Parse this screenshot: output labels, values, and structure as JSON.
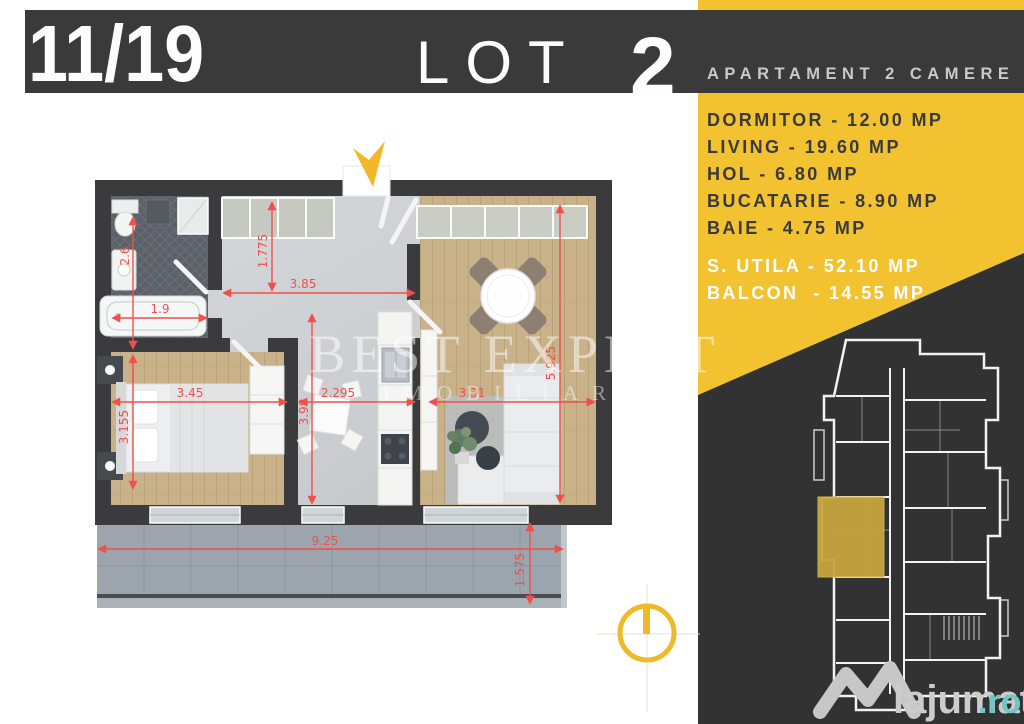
{
  "header": {
    "apartment_fraction": "11/19",
    "lot_label": "LOT",
    "lot_number": "2",
    "subtitle": "APARTAMENT 2 CAMERE"
  },
  "room_list": [
    "DORMITOR - 12.00 MP",
    "LIVING - 19.60 MP",
    "HOL - 6.80 MP",
    "BUCATARIE - 8.90 MP",
    "BAIE - 4.75 MP"
  ],
  "totals": [
    "S. UTILA - 52.10 MP",
    "BALCON  - 14.55 MP"
  ],
  "plan": {
    "dimensions": [
      "2.6",
      "1.9",
      "1.775",
      "3.85",
      "3.45",
      "3.155",
      "3.98",
      "2.295",
      "3.31",
      "5.925",
      "9.25",
      "1.575"
    ],
    "watermark_line1": "BEST EXPERT",
    "watermark_line2": "IMOBILIARE"
  },
  "brand": {
    "name": "lajumate",
    "tld": ".ro"
  },
  "colors": {
    "accent_yellow": "#f2c230",
    "panel_dark": "#323232",
    "wall": "#3b3b3d",
    "dimension_red": "#f0504c",
    "brand_teal": "#6ec7c3",
    "key_plan_highlight": "#c7a53e"
  }
}
